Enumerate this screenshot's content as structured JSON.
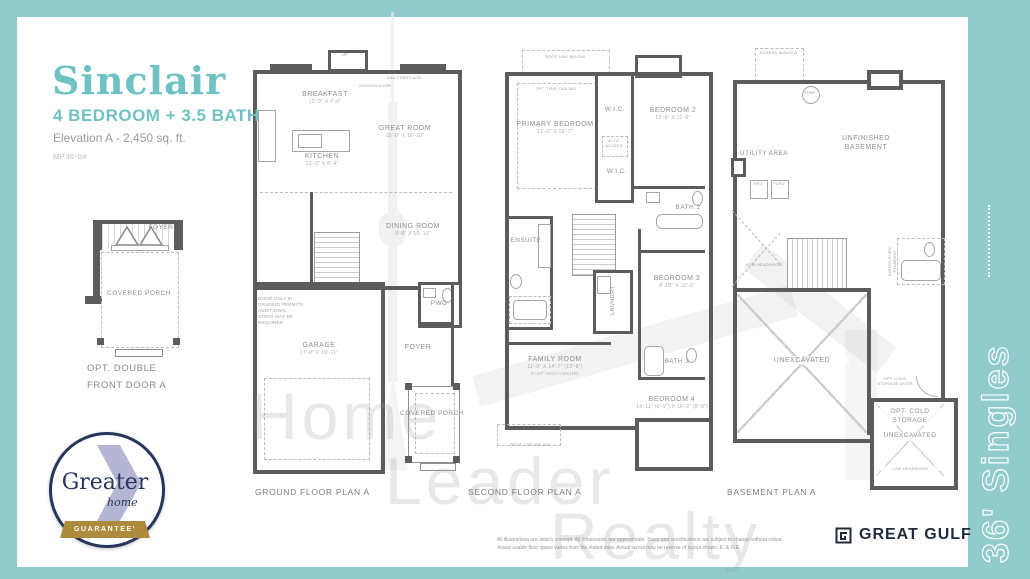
{
  "header": {
    "title": "Sinclair",
    "subtitle": "4 BEDROOM + 3.5 BATH",
    "elevation": "Elevation A - 2,450 sq. ft.",
    "model_code": "MP36-04"
  },
  "option_plan": {
    "foyer": "FOYER",
    "covered_porch": "COVERED PORCH",
    "caption": "OPT. DOUBLE FRONT DOOR A"
  },
  "badge": {
    "greater": "Greater",
    "home": "home",
    "guarantee": "GUARANTEE'"
  },
  "misc": {
    "up": "UP",
    "dn": "DN"
  },
  "plans": {
    "ground": {
      "caption": "GROUND FLOOR PLAN A",
      "breakfast": {
        "name": "BREAKFAST",
        "dims": "12'-0\" X 7'-0\""
      },
      "great_room": {
        "name": "GREAT ROOM",
        "dims": "15'-0\" X 16'-10\""
      },
      "kitchen": {
        "name": "KITCHEN",
        "dims": "12'-0\" X 8'-4\""
      },
      "dining": {
        "name": "DINING ROOM",
        "dims": "9'-8\" X 10'-10\""
      },
      "garage": {
        "name": "GARAGE",
        "dims": "17'-0\" X 19'-11\""
      },
      "pwd": "PWD",
      "foyer": "FOYER",
      "covered_porch": "COVERED PORCH",
      "gas_fireplace": "GAS FIREPLACE",
      "garden_door": "GARDEN DOOR",
      "door_note": "DOOR ONLY IF GRADING PERMITS ADDITIONAL STEPS MAY BE REQUIRED"
    },
    "second": {
      "caption": "SECOND FLOOR PLAN A",
      "roof_line": "ROOF LINE BELOW",
      "primary": {
        "name": "PRIMARY BEDROOM",
        "dims": "12'-0\" X 15'-7\""
      },
      "opt_tray": "OPT. TRAY CEILING",
      "wic": "W.I.C.",
      "attic": "ATTIC ACCESS",
      "bedroom2": {
        "name": "BEDROOM 2",
        "dims": "10'-6\" X 11'-6\""
      },
      "bath2": "BATH 2",
      "ensuite": "ENSUITE",
      "laundry": "LAUNDRY",
      "bedroom3": {
        "name": "BEDROOM 3",
        "dims": "8'-10\" X 12'-0\""
      },
      "bath3": "BATH 3",
      "family": {
        "name": "FAMILY ROOM",
        "dims": "11'-9\" X 14'-7\" (13'-8\")",
        "note": "9'-10\" HIGH CEILING"
      },
      "bedroom4": {
        "name": "BEDROOM 4",
        "dims": "14'-11\" (9'-9\") X 16'-2\" (8'-0\")"
      }
    },
    "basement": {
      "caption": "BASEMENT PLAN A",
      "egress": "EGRESS WINDOW",
      "sump": "SUMP",
      "unfinished": "UNFINISHED BASEMENT",
      "utility": "UTILITY AREA",
      "hrv": "HRV",
      "furn": "FURN",
      "low_headroom": "LOW HEADROOM",
      "unexcavated": "UNEXCAVATED",
      "rough_in": "ROUGH-IN 3PC PLUMBING",
      "cold_door": "OPT. COLD STORAGE DOOR",
      "cold_storage": "OPT. COLD STORAGE"
    }
  },
  "side_band": {
    "label": "36' Singles"
  },
  "watermark": {
    "line1": "Home",
    "line2": "Leader",
    "line3": "Realty"
  },
  "footer": {
    "disclaimer1": "All illustrations are artist's concept. All dimensions are approximate. Sizes and specifications are subject to change without notice.",
    "disclaimer2": "Actual usable floor space varies from the stated area. Actual layout may be reverse of layout shown. E. & O.E.",
    "brand": "GREAT GULF"
  },
  "colors": {
    "teal_frame": "#92cbcb",
    "title_teal": "#6fc2c4",
    "navy": "#26365c",
    "gold": "#ad8a3c",
    "lavender": "#b5b6d4",
    "wall_gray": "#5c5c5c"
  }
}
